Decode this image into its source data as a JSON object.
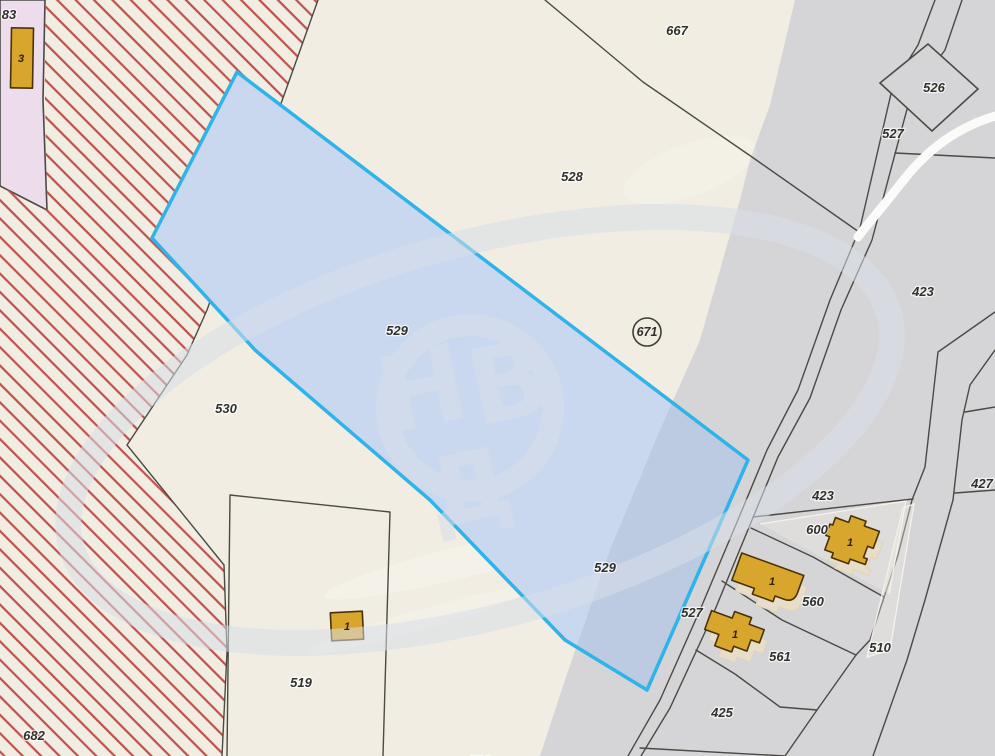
{
  "map": {
    "type": "cadastral-parcel-map",
    "selected_parcel_id": "529",
    "watermark": {
      "letters": [
        "Н",
        "В",
        "Д"
      ]
    },
    "colors": {
      "parcel_cream": "#f1ede2",
      "road_gray": "#d5d4d6",
      "restricted_pink": "#ecdcec",
      "hatch_red": "#c0504c",
      "selection_fill": "#c9d7ef",
      "selection_fill_on_gray": "#bccae2",
      "selection_border": "#2fb3e8",
      "building_fill": "#d9a62d",
      "building_border": "#4a3208",
      "boundary_line": "#4b4a45",
      "white_road": "#fbfbfa"
    },
    "labels": {
      "parcels": [
        {
          "text": "83",
          "x": 9,
          "y": 19
        },
        {
          "text": "667",
          "x": 677,
          "y": 35
        },
        {
          "text": "526",
          "x": 934,
          "y": 92
        },
        {
          "text": "527",
          "x": 893,
          "y": 138
        },
        {
          "text": "528",
          "x": 572,
          "y": 181
        },
        {
          "text": "423",
          "x": 923,
          "y": 296
        },
        {
          "text": "529",
          "x": 397,
          "y": 335
        },
        {
          "text": "530",
          "x": 226,
          "y": 413
        },
        {
          "text": "427",
          "x": 982,
          "y": 488
        },
        {
          "text": "423",
          "x": 823,
          "y": 500
        },
        {
          "text": "600",
          "x": 817,
          "y": 534
        },
        {
          "text": "529",
          "x": 605,
          "y": 572
        },
        {
          "text": "560",
          "x": 813,
          "y": 606
        },
        {
          "text": "527",
          "x": 692,
          "y": 617
        },
        {
          "text": "510",
          "x": 880,
          "y": 652
        },
        {
          "text": "561",
          "x": 780,
          "y": 661
        },
        {
          "text": "519",
          "x": 301,
          "y": 687
        },
        {
          "text": "425",
          "x": 722,
          "y": 717
        },
        {
          "text": "682",
          "x": 34,
          "y": 740
        },
        {
          "text": "520",
          "x": 480,
          "y": 765
        }
      ],
      "buildings": [
        {
          "text": "3",
          "x": 21,
          "y": 62
        },
        {
          "text": "1",
          "x": 347,
          "y": 630
        },
        {
          "text": "1",
          "x": 850,
          "y": 546
        },
        {
          "text": "1",
          "x": 772,
          "y": 585
        },
        {
          "text": "1",
          "x": 735,
          "y": 638
        }
      ],
      "circled": "671"
    }
  }
}
